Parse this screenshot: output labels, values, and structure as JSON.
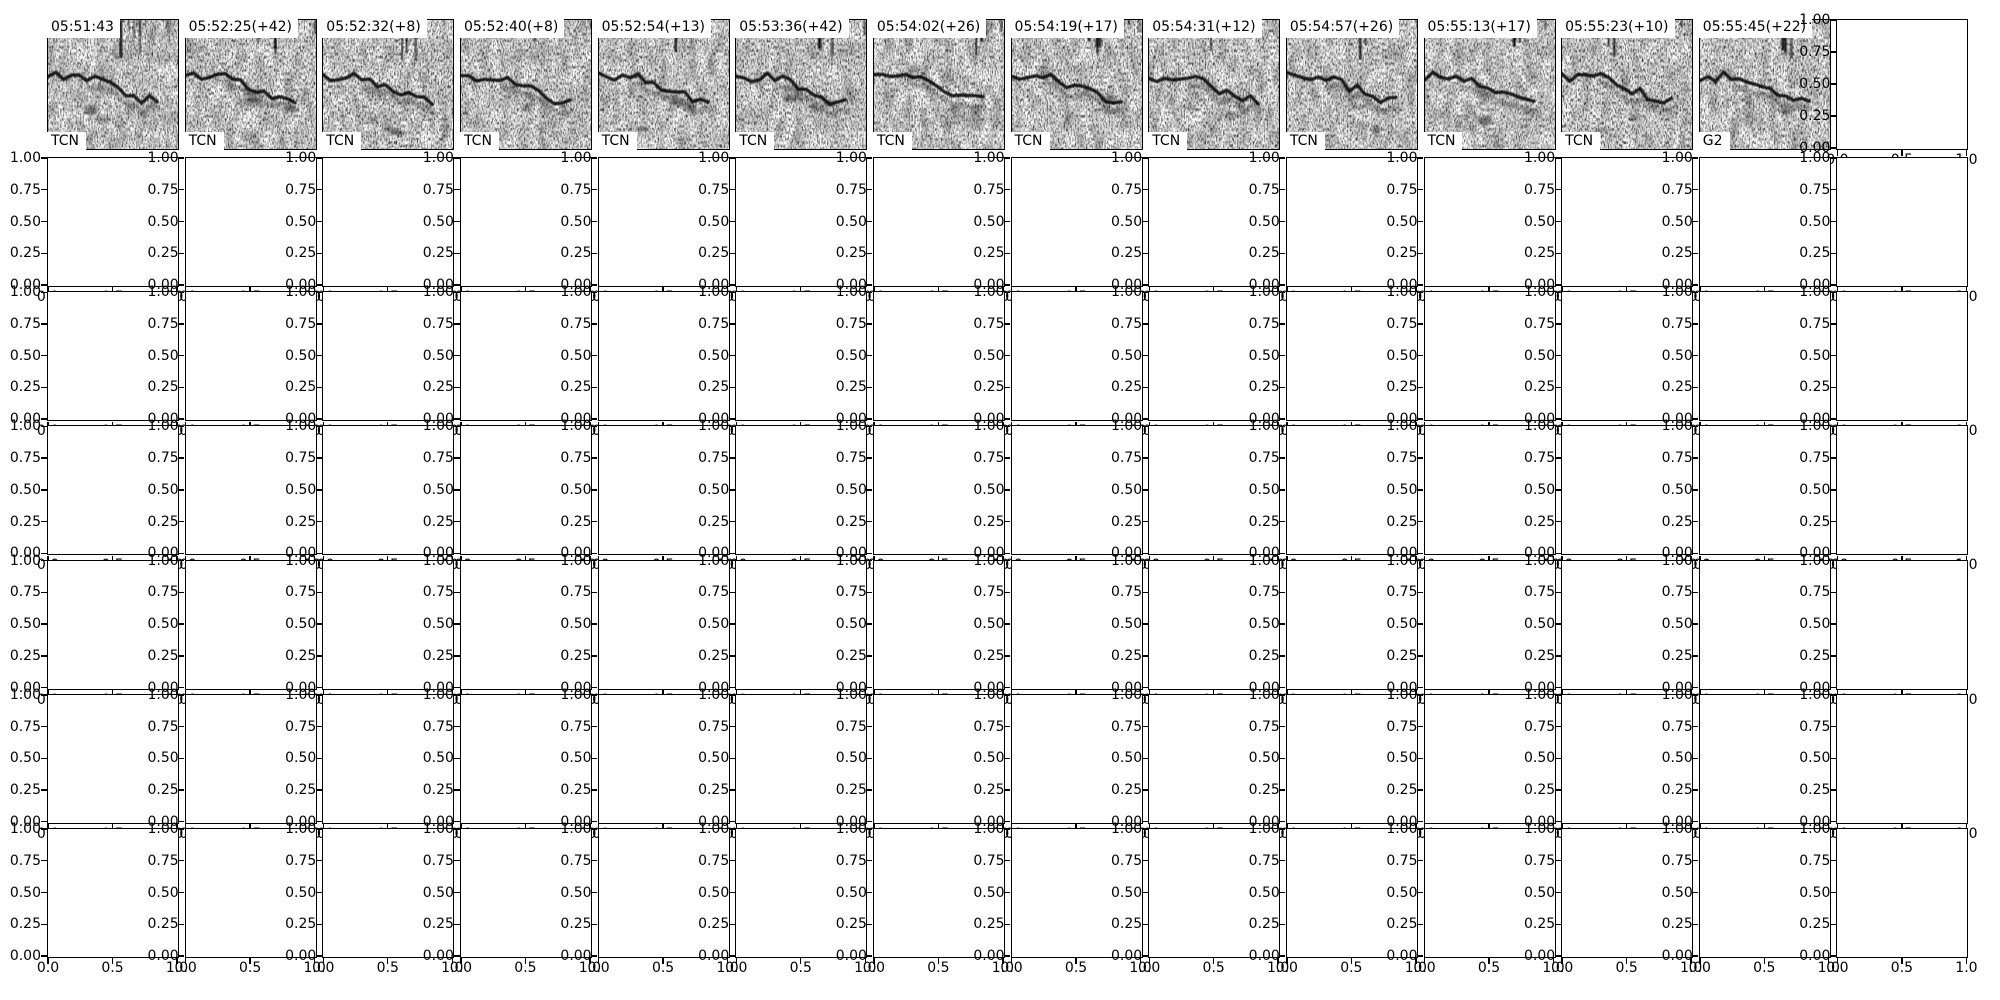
{
  "figure": {
    "background": "#ffffff",
    "text_color": "#000000",
    "spine_color": "#000000"
  },
  "chart_data": {
    "type": "heatmap",
    "title": "",
    "description": "Top row: 13 grayscale spectrogram detection panels, each with a timestamp label (top-left) and a detector label (bottom-left), plus one empty axes at far right. Below: 6 rows x 14 columns of empty axes with default 0-1 limits and overlapping tick labels.",
    "top_row": {
      "n_panels": 13,
      "panels": [
        {
          "timestamp": "05:51:43",
          "label": "TCN"
        },
        {
          "timestamp": "05:52:25(+42)",
          "label": "TCN"
        },
        {
          "timestamp": "05:52:32(+8)",
          "label": "TCN"
        },
        {
          "timestamp": "05:52:40(+8)",
          "label": "TCN"
        },
        {
          "timestamp": "05:52:54(+13)",
          "label": "TCN"
        },
        {
          "timestamp": "05:53:36(+42)",
          "label": "TCN"
        },
        {
          "timestamp": "05:54:02(+26)",
          "label": "TCN"
        },
        {
          "timestamp": "05:54:19(+17)",
          "label": "TCN"
        },
        {
          "timestamp": "05:54:31(+12)",
          "label": "TCN"
        },
        {
          "timestamp": "05:54:57(+26)",
          "label": "TCN"
        },
        {
          "timestamp": "05:55:13(+17)",
          "label": "TCN"
        },
        {
          "timestamp": "05:55:23(+10)",
          "label": "TCN"
        },
        {
          "timestamp": "05:55:45(+22)",
          "label": "G2"
        }
      ]
    },
    "empty_grid": {
      "rows": 6,
      "cols": 14,
      "xlim": [
        0,
        1
      ],
      "ylim": [
        0,
        1
      ],
      "x_ticks": [
        "0.0",
        "0.5",
        "1.0"
      ],
      "y_ticks": [
        "1.00",
        "0.75",
        "0.50",
        "0.25",
        "0.00"
      ]
    }
  }
}
